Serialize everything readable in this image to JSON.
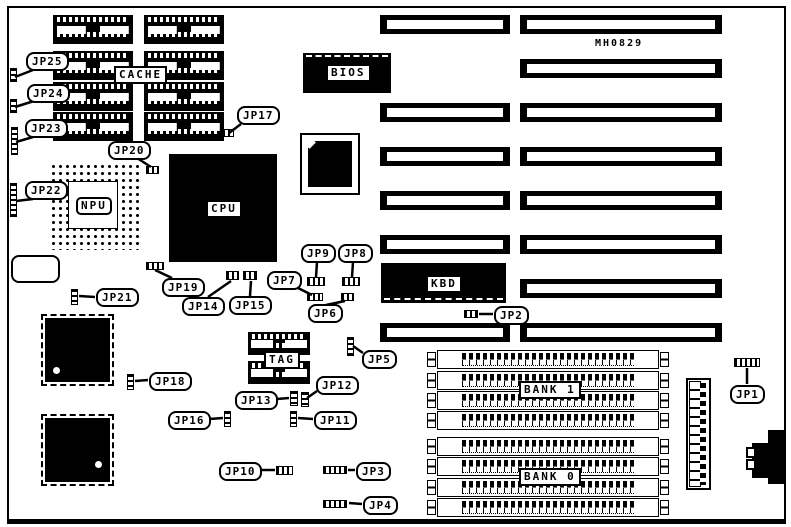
{
  "diagram": {
    "part_number": "MH0829",
    "components": {
      "cache": "CACHE",
      "npu": "NPU",
      "cpu": "CPU",
      "bios": "BIOS",
      "kbd": "KBD",
      "tag": "TAG",
      "bank1": "BANK 1",
      "bank0": "BANK 0"
    },
    "jumpers": {
      "jp1": "JP1",
      "jp2": "JP2",
      "jp3": "JP3",
      "jp4": "JP4",
      "jp5": "JP5",
      "jp6": "JP6",
      "jp7": "JP7",
      "jp8": "JP8",
      "jp9": "JP9",
      "jp10": "JP10",
      "jp11": "JP11",
      "jp12": "JP12",
      "jp13": "JP13",
      "jp14": "JP14",
      "jp15": "JP15",
      "jp16": "JP16",
      "jp17": "JP17",
      "jp18": "JP18",
      "jp19": "JP19",
      "jp20": "JP20",
      "jp21": "JP21",
      "jp22": "JP22",
      "jp23": "JP23",
      "jp24": "JP24",
      "jp25": "JP25"
    }
  }
}
